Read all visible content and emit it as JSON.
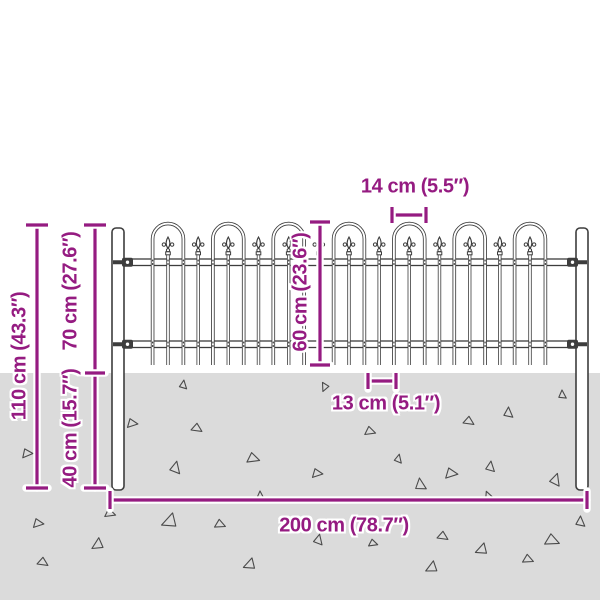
{
  "diagram_title": "Garden fence with hooped top – dimension diagram",
  "colors": {
    "dimension": "#951B81",
    "outline": "#3D3D3D",
    "triangle": "#4A4A4A",
    "ground": "#DBDBDB",
    "metal_fill": "#FFFFFF",
    "background": "#FFFFFF"
  },
  "ground": {
    "top": 373,
    "height": 227
  },
  "fence": {
    "posts": [
      {
        "x": 112,
        "w": 12,
        "top": 228,
        "bottom": 490
      },
      {
        "x": 576,
        "w": 12,
        "top": 228,
        "bottom": 490
      }
    ],
    "rails": [
      {
        "x1": 124,
        "x2": 576,
        "y": 259,
        "h": 6.5
      },
      {
        "x1": 124,
        "x2": 576,
        "y": 341,
        "h": 6.5
      }
    ],
    "hoops": {
      "centers": [
        168,
        228.3,
        288.7,
        349,
        409.3,
        469.7,
        530
      ],
      "leg_offset": 15.4,
      "arc_center_y": 239,
      "tube_w": 3.6,
      "inner_w": 1.9
    },
    "singles": {
      "centers": [
        198.2,
        258.5,
        318.8,
        379.2,
        439.5,
        499.8
      ]
    },
    "spear": {
      "tip_y": 237,
      "bar_top": 250
    },
    "bars_bottom": 365
  },
  "dimensions": {
    "hoop_width": {
      "label": "14 cm (5.5″)",
      "type": "h-bracket",
      "x1": 392,
      "x2": 426,
      "y": 215,
      "cap": 8,
      "label_x": 415,
      "label_y": 187,
      "rot": 0
    },
    "panel_height": {
      "label": "60 cm (23.6″)",
      "type": "v-line",
      "x": 320,
      "y1": 222,
      "y2": 365,
      "cap": 10,
      "label_x": 301,
      "label_y": 292,
      "rot": -90
    },
    "bar_spacing": {
      "label": "13 cm (5.1″)",
      "type": "h-bracket",
      "x1": 368,
      "x2": 396,
      "y": 381,
      "cap": 8,
      "label_x": 386,
      "label_y": 404,
      "rot": 0
    },
    "total_width": {
      "label": "200 cm (78.7″)",
      "type": "h-line",
      "x1": 110,
      "x2": 587,
      "y": 500,
      "cap": 9,
      "label_x": 344,
      "label_y": 526,
      "rot": 0
    },
    "total_height": {
      "label": "110 cm (43.3″)",
      "type": "v-line",
      "x": 37,
      "y1": 225,
      "y2": 488,
      "cap": 11,
      "label_x": 20,
      "label_y": 356,
      "rot": -90
    },
    "above_ground": {
      "label": "70 cm (27.6″)",
      "type": "v-line",
      "x": 95,
      "y1": 225,
      "y2": 488,
      "cap": 11,
      "mid_tick": 373,
      "label_x": 71,
      "label_y": 291,
      "rot": -90
    },
    "below_ground": {
      "label": "40 cm (15.7″)",
      "type": "label-only",
      "label_x": 71,
      "label_y": 428,
      "rot": -90
    }
  },
  "triangles": [
    [
      183,
      385,
      5,
      10
    ],
    [
      325,
      387,
      5,
      205
    ],
    [
      132,
      423,
      6,
      100
    ],
    [
      197,
      428,
      6,
      125
    ],
    [
      27,
      453,
      6,
      95
    ],
    [
      253,
      458,
      7,
      110
    ],
    [
      175,
      468,
      7,
      15
    ],
    [
      317,
      473,
      6,
      100
    ],
    [
      562,
      395,
      5,
      0
    ],
    [
      508,
      413,
      6,
      5
    ],
    [
      469,
      421,
      6,
      125
    ],
    [
      370,
      431,
      6,
      110
    ],
    [
      398,
      459,
      5,
      15
    ],
    [
      451,
      473,
      7,
      100
    ],
    [
      420,
      485,
      7,
      355
    ],
    [
      490,
      467,
      6,
      10
    ],
    [
      555,
      480,
      7,
      20
    ],
    [
      110,
      513,
      6,
      110
    ],
    [
      38,
      523,
      6,
      100
    ],
    [
      170,
      522,
      9,
      250
    ],
    [
      220,
      524,
      6,
      115
    ],
    [
      98,
      545,
      7,
      240
    ],
    [
      43,
      562,
      6,
      125
    ],
    [
      318,
      540,
      6,
      15
    ],
    [
      250,
      565,
      7,
      250
    ],
    [
      260,
      495,
      4,
      0
    ],
    [
      488,
      496,
      5,
      340
    ],
    [
      580,
      522,
      6,
      5
    ],
    [
      552,
      540,
      8,
      115
    ],
    [
      443,
      536,
      6,
      125
    ],
    [
      482,
      550,
      7,
      250
    ],
    [
      528,
      559,
      6,
      115
    ],
    [
      373,
      543,
      5,
      110
    ],
    [
      432,
      568,
      7,
      245
    ]
  ]
}
